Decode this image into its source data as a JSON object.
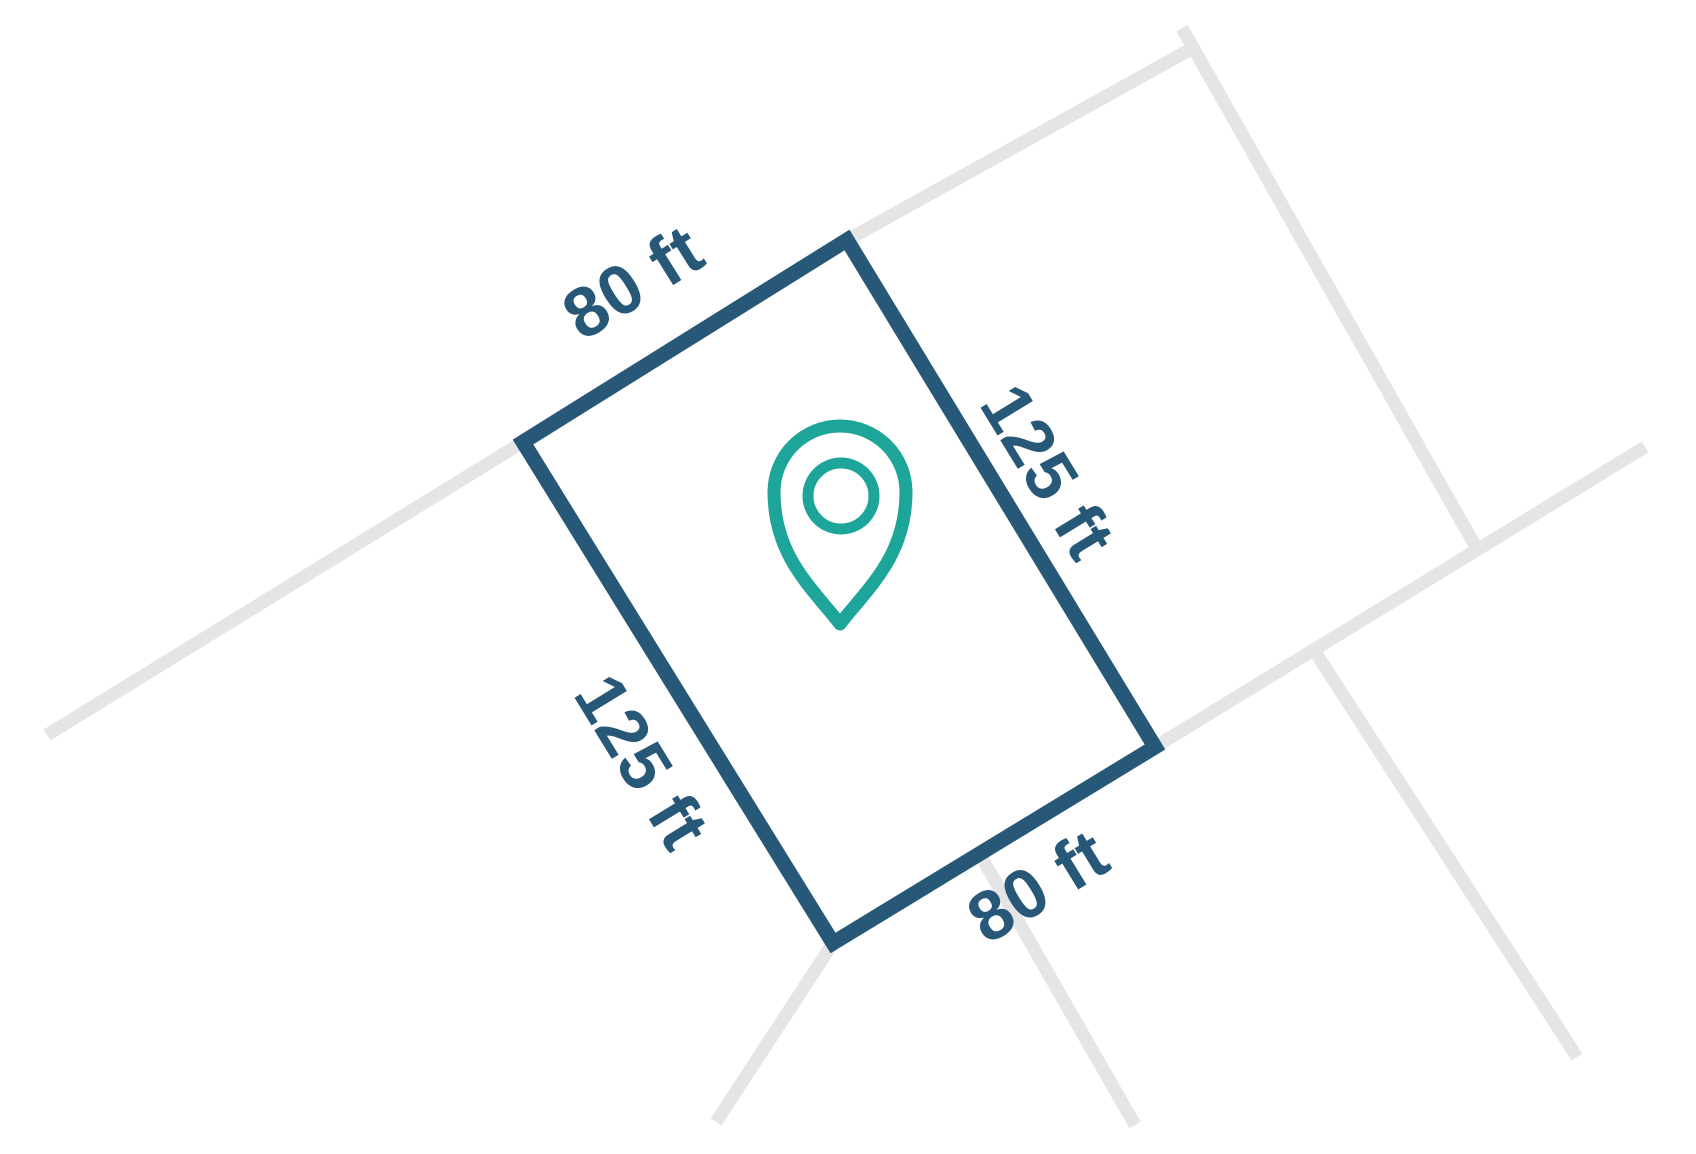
{
  "lot_diagram": {
    "dimension_labels": {
      "top": "80 ft",
      "right": "125 ft",
      "left": "125 ft",
      "bottom": "80 ft"
    },
    "marker_icon": "location-pin-icon",
    "colors": {
      "lot_outline": "#275878",
      "label_text": "#275878",
      "marker_teal": "#1EA59A",
      "road_line_gray": "#E5E5E5",
      "background": "#FFFFFF"
    }
  }
}
